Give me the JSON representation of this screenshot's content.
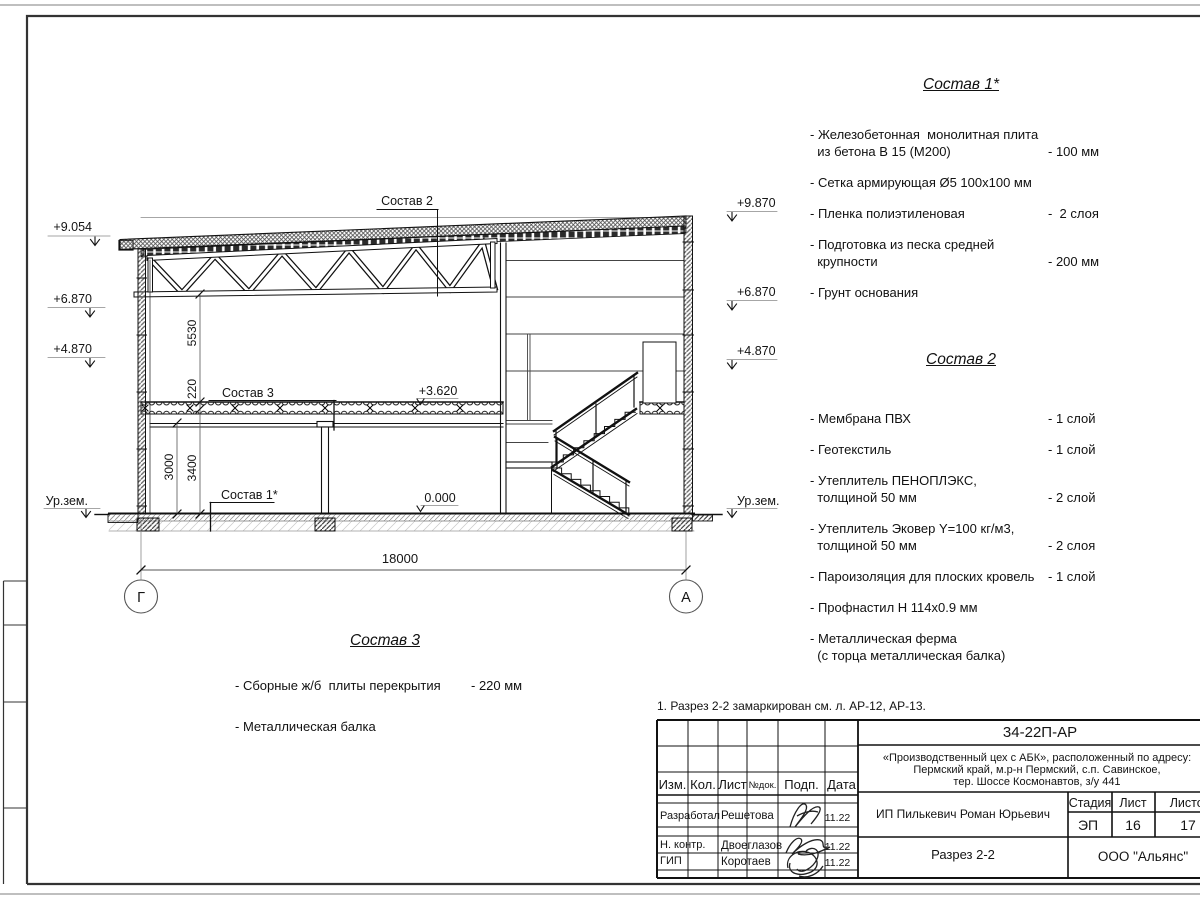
{
  "note": "1. Разрез 2-2 замаркирован см. л. АР-12, АР-13.",
  "compositions": {
    "c1": {
      "title": "Состав 1*",
      "items": [
        {
          "label": "- Железобетонная  монолитная плита\n  из бетона В 15 (М200)",
          "value": "- 100 мм"
        },
        {
          "label": "- Сетка армирующая Ø5 100х100 мм",
          "value": ""
        },
        {
          "label": "- Пленка полиэтиленовая",
          "value": "-  2 слоя"
        },
        {
          "label": "- Подготовка из песка средней\n  крупности",
          "value": "- 200 мм"
        },
        {
          "label": "- Грунт основания",
          "value": ""
        }
      ]
    },
    "c2": {
      "title": "Состав 2",
      "items": [
        {
          "label": "- Мембрана ПВХ",
          "value": "- 1 слой"
        },
        {
          "label": "- Геотекстиль",
          "value": "- 1 слой"
        },
        {
          "label": "- Утеплитель ПЕНОПЛЭКС,\n  толщиной 50 мм",
          "value": "- 2 слой"
        },
        {
          "label": "- Утеплитель Эковер Y=100 кг/м3,\n  толщиной 50 мм",
          "value": "- 2 слоя"
        },
        {
          "label": "- Пароизоляция для плоских кровель",
          "value": "- 1 слой"
        },
        {
          "label": "- Профнастил Н 114х0.9 мм",
          "value": ""
        },
        {
          "label": "- Металлическая ферма\n  (с торца металлическая балка)",
          "value": ""
        }
      ]
    },
    "c3": {
      "title": "Состав 3",
      "items": [
        {
          "label": "- Сборные ж/б  плиты перекрытия",
          "value": "- 220 мм"
        },
        {
          "label": "- Металлическая балка",
          "value": ""
        }
      ]
    }
  },
  "drawing": {
    "elev_l": [
      "+9.054",
      "+6.870",
      "+4.870",
      "Ур.зем."
    ],
    "elev_r": [
      "+9.870",
      "+6.870",
      "+4.870",
      "Ур.зем."
    ],
    "callout_c2": "Состав 2",
    "callout_c3": "Состав 3",
    "callout_c1": "Состав 1*",
    "lvl_362": "+3.620",
    "lvl_0": "0.000",
    "dim_18000": "18000",
    "dim_5530": "5530",
    "dim_220": "220",
    "dim_3000": "3000",
    "dim_3400": "3400",
    "axis_g": "Г",
    "axis_a": "А"
  },
  "titleblock": {
    "doc_code": "34-22П-АР",
    "project_line1": "«Производственный цех с АБК», расположенный по адресу:",
    "project_line2": "Пермский край, м.р-н Пермский, с.п. Савинское,",
    "project_line3": "тер. Шоссе Космонавтов, з/у 441",
    "client": "ИП Пилькевич Роман Юрьевич",
    "sheet_title": "Разрез 2-2",
    "company": "ООО \"Альянс\"",
    "stage_label": "Стадия",
    "stage": "ЭП",
    "sheet_label": "Лист",
    "sheet": "16",
    "sheets_label": "Листов",
    "sheets": "17",
    "cols": [
      "Изм.",
      "Кол.",
      "Лист",
      "№док.",
      "Подп.",
      "Дата"
    ],
    "rows": [
      {
        "role": "Разработал",
        "name": "Решетова",
        "date": "11.22"
      },
      {
        "role": "Н. контр.",
        "name": "Двоеглазов",
        "date": "11.22"
      },
      {
        "role": "ГИП",
        "name": "Коротаев",
        "date": "11.22"
      }
    ]
  }
}
